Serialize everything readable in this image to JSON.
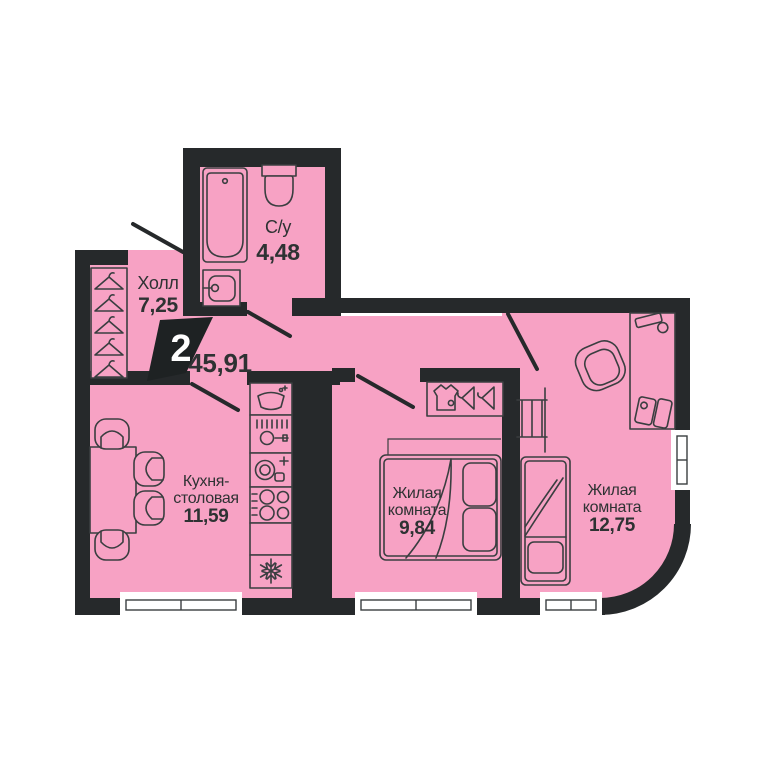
{
  "plan": {
    "badge_rooms_count": "2",
    "total_area": "45,91",
    "rooms": [
      {
        "id": "bathroom",
        "name": "С/у",
        "area": "4,48"
      },
      {
        "id": "hall",
        "name": "Холл",
        "area": "7,25"
      },
      {
        "id": "kitchen_dining",
        "name_line1": "Кухня-",
        "name_line2": "столовая",
        "area": "11,59"
      },
      {
        "id": "living_room_1",
        "name_line1": "Жилая",
        "name_line2": "комната",
        "area": "9,84"
      },
      {
        "id": "living_room_2",
        "name_line1": "Жилая",
        "name_line2": "комната",
        "area": "12,75"
      }
    ]
  },
  "colors": {
    "background": "#ffffff",
    "floor_pink": "#F7A2C4",
    "wall_dark": "#26292B",
    "furniture_stroke": "#3A3E40",
    "text_dark": "#2E3233",
    "badge_bg": "#1E2223",
    "badge_text": "#ffffff"
  },
  "icons": {
    "bathroom": [
      "bathtub-icon",
      "toilet-icon",
      "sink-icon"
    ],
    "hall": [
      "hanger-icon"
    ],
    "kitchen": [
      "dining-table-icon",
      "chair-icon",
      "kitchen-sink-icon",
      "washing-machine-icon",
      "dishwasher-icon",
      "cooktop-icon",
      "fridge-snowflake-icon"
    ],
    "living_room_1": [
      "wardrobe-shirt-icon",
      "hanger-icon",
      "double-bed-icon"
    ],
    "living_room_2": [
      "wall-ladder-icon",
      "single-bed-icon",
      "desk-icon",
      "desk-lamp-icon",
      "computer-icon",
      "office-chair-icon"
    ]
  }
}
